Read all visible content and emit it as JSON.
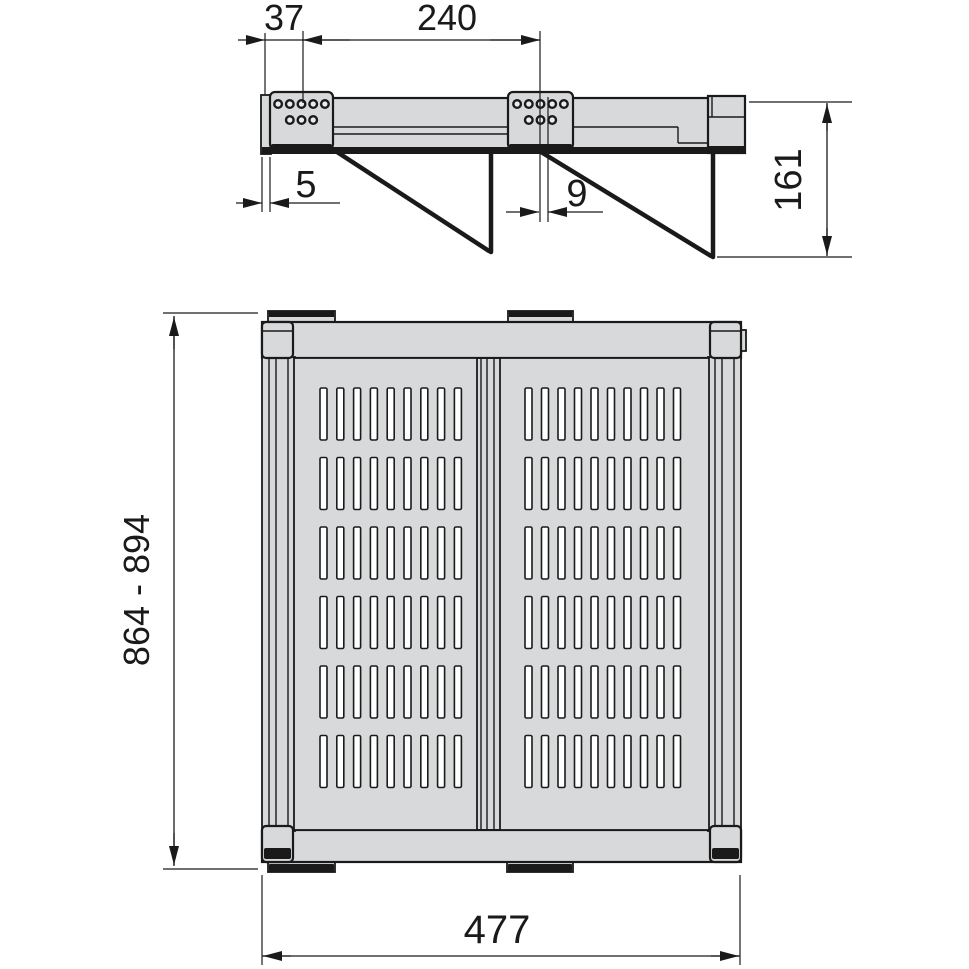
{
  "colors": {
    "background": "#ffffff",
    "line": "#1a1a1a",
    "metal_gray": "#d7d9da",
    "slot_white": "#ffffff"
  },
  "side_view": {
    "dimensions": {
      "bracket_offset": "37",
      "bracket_spacing": "240",
      "front_gap": "5",
      "hook_offset": "9",
      "drop_height": "161"
    },
    "brackets": [
      {
        "holes_top": 5,
        "holes_bottom": 3
      },
      {
        "holes_top": 5,
        "holes_bottom": 3
      }
    ]
  },
  "front_view": {
    "dimensions": {
      "height_range": "864 - 894",
      "width": "477"
    },
    "panels": [
      {
        "slot_rows": 6,
        "slot_cols": 9
      },
      {
        "slot_rows": 6,
        "slot_cols": 10
      }
    ]
  }
}
